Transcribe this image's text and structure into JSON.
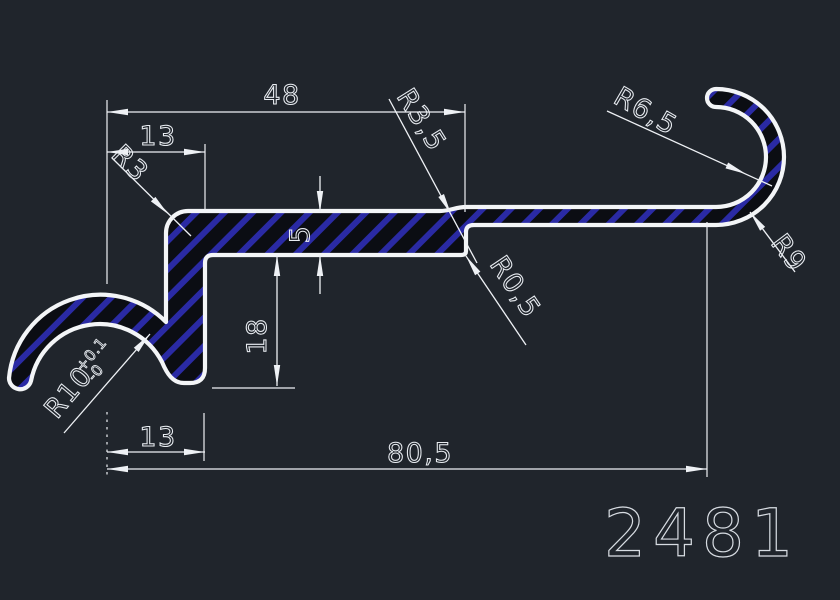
{
  "canvas": {
    "part_number": "2481",
    "background_color": "#20252c",
    "line_color": "#eef1f5",
    "hatch_stripe_color": "#2a2aa4",
    "hatch_background_color": "#0b0d13"
  },
  "dimensions": {
    "top_width": "48",
    "top_left_width": "13",
    "plate_thickness": "5",
    "leg_height": "18",
    "bottom_left_width": "13",
    "overall_width": "80,5"
  },
  "radii": {
    "top_left_corner": "R3",
    "step_fillet": "R3,5",
    "step_corner": "R0,5",
    "hook_inner": "R6,5",
    "hook_outer": "R9",
    "arch_inner": "R10",
    "arch_inner_tol_upper": "+0.1",
    "arch_inner_tol_lower": "-0"
  }
}
